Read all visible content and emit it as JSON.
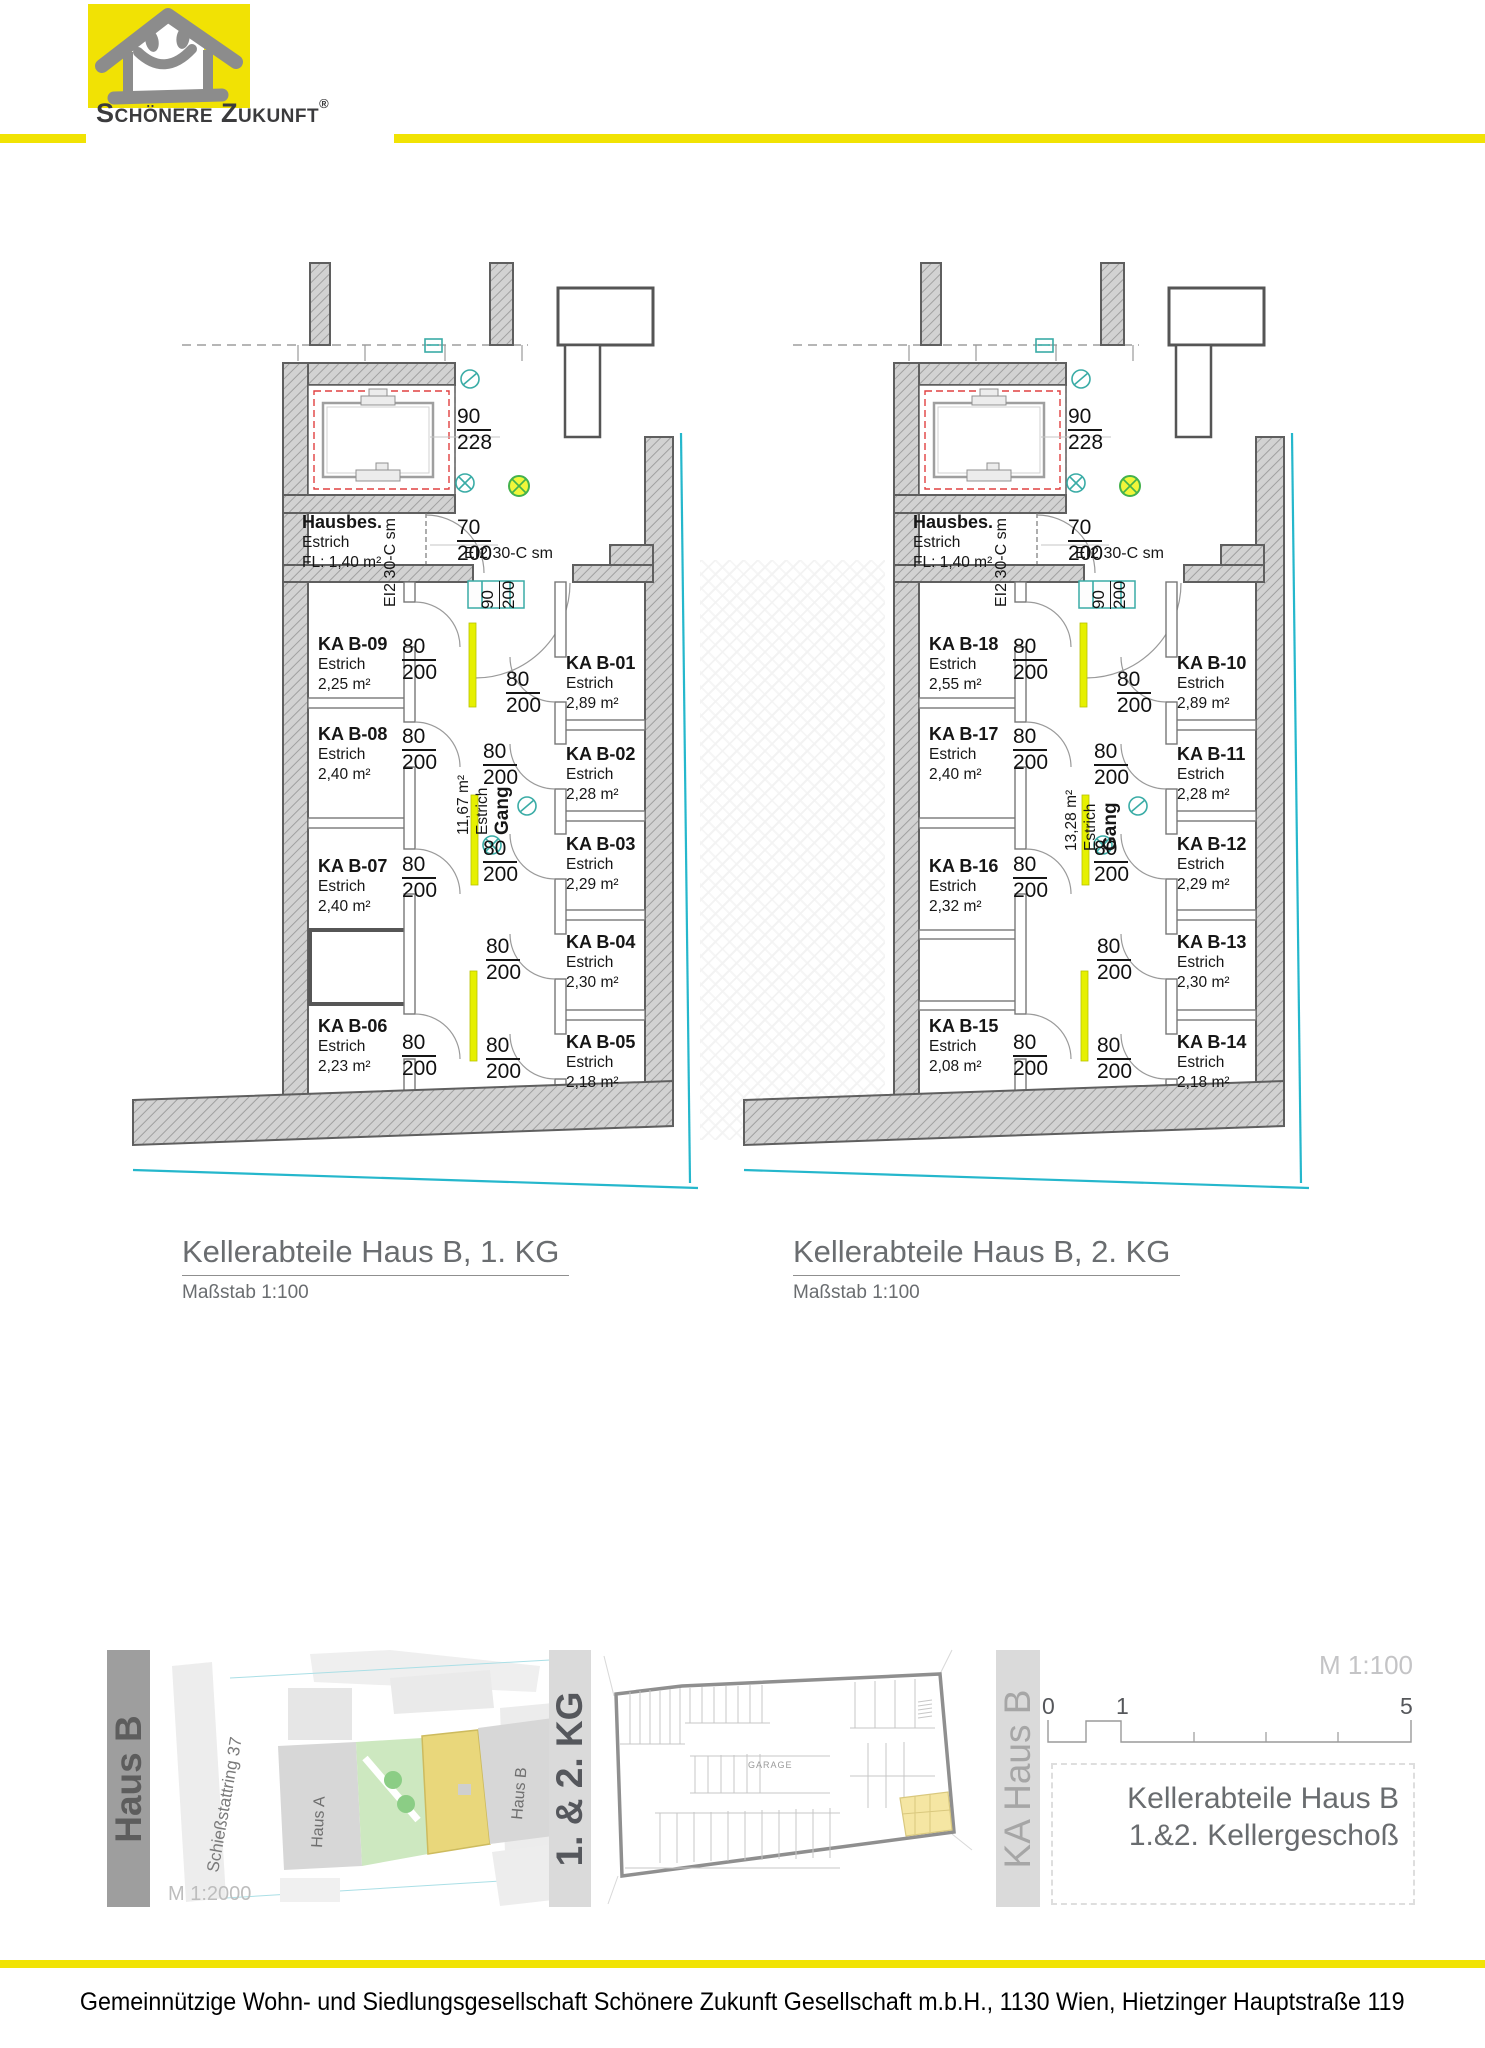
{
  "header": {
    "brand": "Schönere Zukunft",
    "registered": "®"
  },
  "plans": [
    {
      "title": "Kellerabteile Haus B, 1. KG",
      "scale_label": "Maßstab 1:100",
      "hausbes": {
        "name": "Hausbes.",
        "floor": "Estrich",
        "area": "FL: 1,40 m²"
      },
      "gang": {
        "name": "Gang",
        "floor": "Estrich",
        "area": "11,67 m²"
      },
      "fire_rating": "EI2 30-C sm",
      "dims": {
        "elevator": {
          "w": "90",
          "h": "228"
        },
        "door70": {
          "w": "70",
          "h": "200"
        },
        "door90": {
          "w": "90",
          "h": "200"
        }
      },
      "left_column": [
        {
          "name": "KA B-09",
          "floor": "Estrich",
          "area": "2,25 m²",
          "dim_w": "80",
          "dim_h": "200"
        },
        {
          "name": "KA B-08",
          "floor": "Estrich",
          "area": "2,40 m²",
          "dim_w": "80",
          "dim_h": "200"
        },
        {
          "name": "KA B-07",
          "floor": "Estrich",
          "area": "2,40 m²",
          "dim_w": "80",
          "dim_h": "200"
        },
        {
          "name": "KA B-06",
          "floor": "Estrich",
          "area": "2,23 m²",
          "dim_w": "80",
          "dim_h": "200"
        }
      ],
      "right_column": [
        {
          "name": "KA B-01",
          "floor": "Estrich",
          "area": "2,89 m²",
          "dim_w": "80",
          "dim_h": "200"
        },
        {
          "name": "KA B-02",
          "floor": "Estrich",
          "area": "2,28 m²",
          "dim_w": "80",
          "dim_h": "200"
        },
        {
          "name": "KA B-03",
          "floor": "Estrich",
          "area": "2,29 m²",
          "dim_w": "80",
          "dim_h": "200"
        },
        {
          "name": "KA B-04",
          "floor": "Estrich",
          "area": "2,30 m²",
          "dim_w": "80",
          "dim_h": "200"
        },
        {
          "name": "KA B-05",
          "floor": "Estrich",
          "area": "2,18 m²",
          "dim_w": "80",
          "dim_h": "200"
        }
      ]
    },
    {
      "title": "Kellerabteile Haus B, 2. KG",
      "scale_label": "Maßstab 1:100",
      "hausbes": {
        "name": "Hausbes.",
        "floor": "Estrich",
        "area": "FL: 1,40 m²"
      },
      "gang": {
        "name": "Gang",
        "floor": "Estrich",
        "area": "13,28 m²"
      },
      "fire_rating": "EI2 30-C sm",
      "dims": {
        "elevator": {
          "w": "90",
          "h": "228"
        },
        "door70": {
          "w": "70",
          "h": "200"
        },
        "door90": {
          "w": "90",
          "h": "200"
        }
      },
      "left_column": [
        {
          "name": "KA B-18",
          "floor": "Estrich",
          "area": "2,55 m²",
          "dim_w": "80",
          "dim_h": "200"
        },
        {
          "name": "KA B-17",
          "floor": "Estrich",
          "area": "2,40 m²",
          "dim_w": "80",
          "dim_h": "200"
        },
        {
          "name": "KA B-16",
          "floor": "Estrich",
          "area": "2,32 m²",
          "dim_w": "80",
          "dim_h": "200"
        },
        {
          "name": "KA B-15",
          "floor": "Estrich",
          "area": "2,08 m²",
          "dim_w": "80",
          "dim_h": "200"
        }
      ],
      "right_column": [
        {
          "name": "KA B-10",
          "floor": "Estrich",
          "area": "2,89 m²",
          "dim_w": "80",
          "dim_h": "200"
        },
        {
          "name": "KA B-11",
          "floor": "Estrich",
          "area": "2,28 m²",
          "dim_w": "80",
          "dim_h": "200"
        },
        {
          "name": "KA B-12",
          "floor": "Estrich",
          "area": "2,29 m²",
          "dim_w": "80",
          "dim_h": "200"
        },
        {
          "name": "KA B-13",
          "floor": "Estrich",
          "area": "2,30 m²",
          "dim_w": "80",
          "dim_h": "200"
        },
        {
          "name": "KA B-14",
          "floor": "Estrich",
          "area": "2,18 m²",
          "dim_w": "80",
          "dim_h": "200"
        }
      ]
    }
  ],
  "site": {
    "bar_label": "Haus B",
    "street": "Schießstattring 37",
    "building_a": "Haus A",
    "building_b": "Haus B",
    "scale": "M 1:2000"
  },
  "keyplan": {
    "bar_label": "1. & 2. KG",
    "garage": "GARAGE",
    "side_label": "KA Haus B"
  },
  "titleblock": {
    "scale": "M 1:100",
    "tick0": "0",
    "tick1": "1",
    "tick5": "5",
    "line1": "Kellerabteile Haus B",
    "line2": "1.&2. Kellergeschoß"
  },
  "footer": {
    "text": "Gemeinnützige Wohn- und Siedlungsgesellschaft Schönere Zukunft Gesellschaft m.b.H., 1130 Wien, Hietzinger Hauptstraße 119"
  },
  "colors": {
    "accent_yellow": "#F1E304",
    "door_yellow": "#E6F000",
    "boundary_cyan": "#25B7CC",
    "symbol_teal": "#3AACA6",
    "symbol_green": "#43B24C"
  }
}
